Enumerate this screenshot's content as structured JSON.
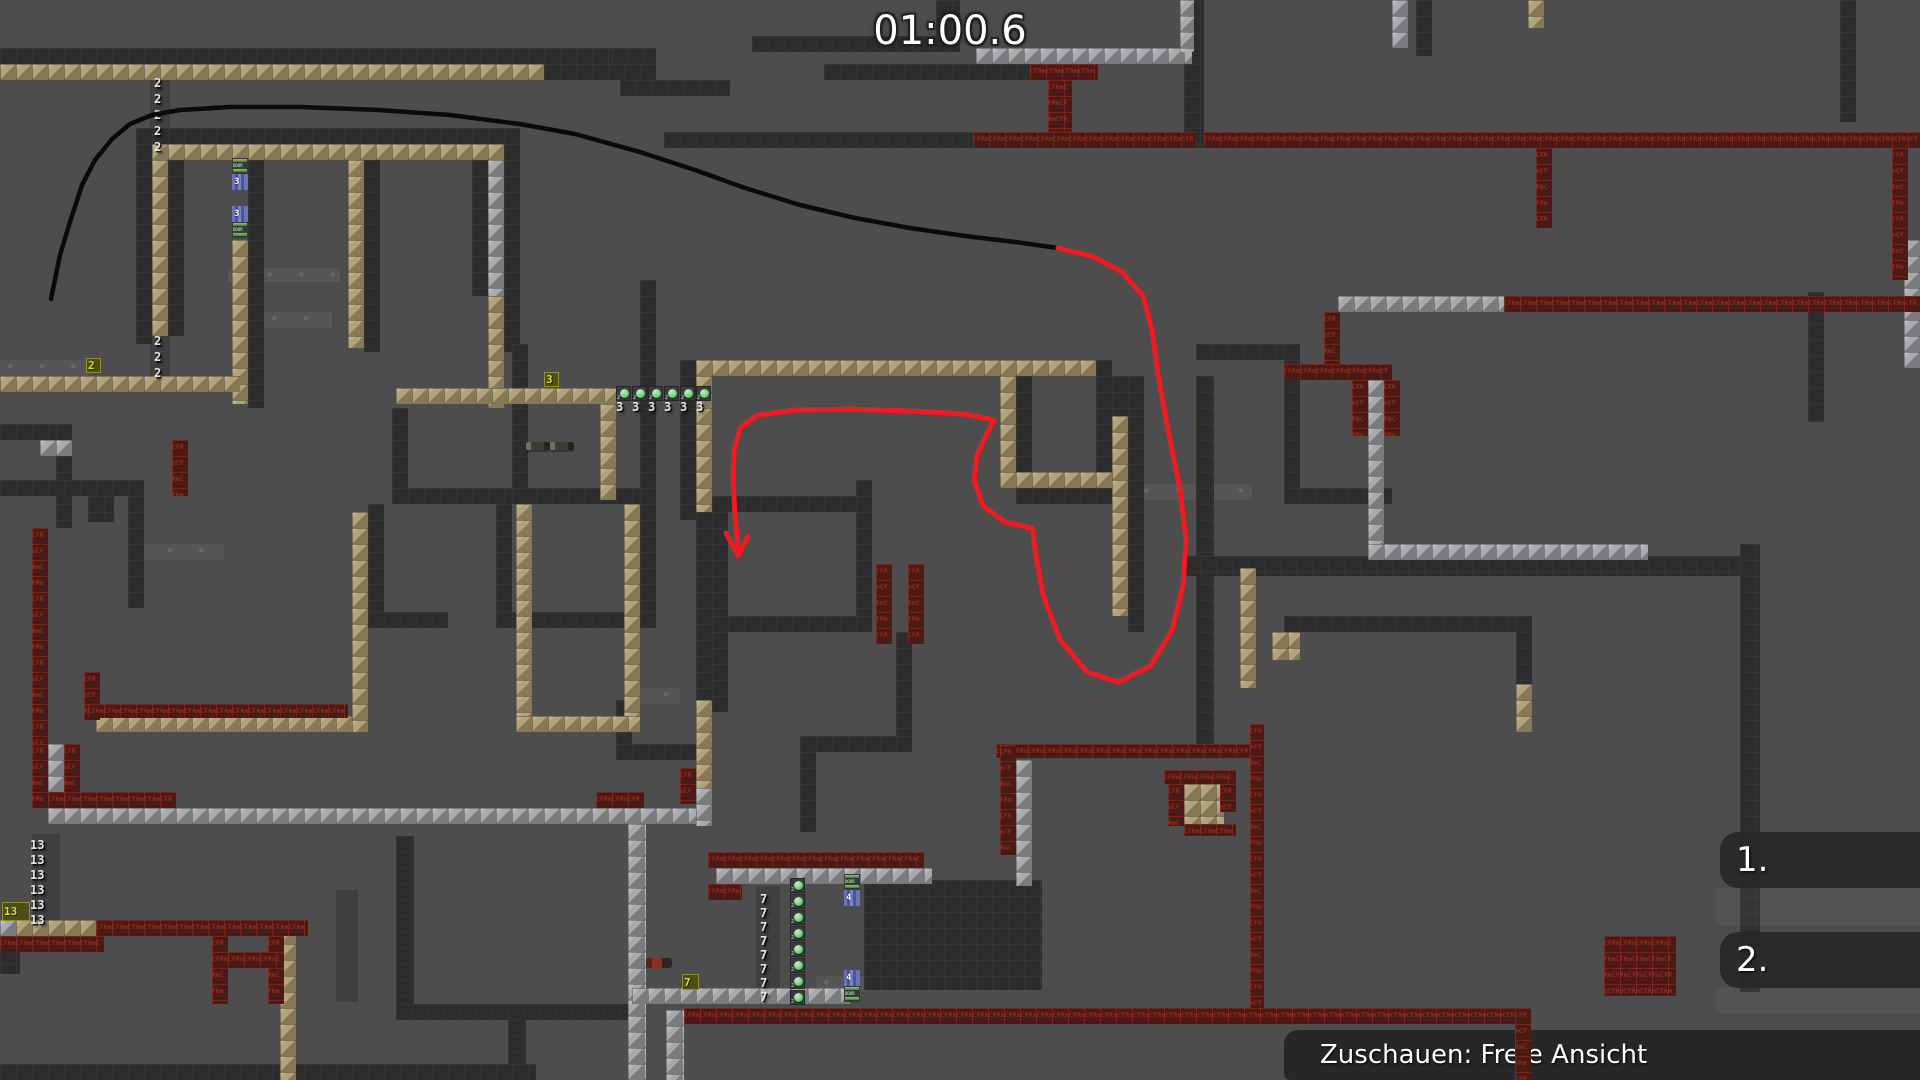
{
  "hud": {
    "timer": "01:00.6",
    "spectate_label": "Zuschauen: Freie Ansicht",
    "ranks": [
      "1.",
      "2."
    ]
  },
  "colors": {
    "background": "#4d4d4d",
    "wall": "#2d2d2d",
    "tan_tile": "#b3a277",
    "silver_tile": "#a8aaad",
    "red_tile": "#4a1a17",
    "red_tile_text_color": "#ad382a",
    "black_line": "#0a0a0a",
    "red_line": "#ee1b22",
    "hud_text": "#ffffff"
  },
  "map": {
    "red_tile_text": "CFRm",
    "star_char": "✶ ",
    "door_label": "DOOR",
    "button_small_label": "2",
    "walls": [
      [
        0,
        48,
        656,
        16
      ],
      [
        544,
        64,
        112,
        16
      ],
      [
        136,
        128,
        384,
        16
      ],
      [
        136,
        144,
        16,
        200
      ],
      [
        168,
        160,
        16,
        176
      ],
      [
        248,
        160,
        16,
        248
      ],
      [
        364,
        160,
        16,
        192
      ],
      [
        472,
        160,
        16,
        136
      ],
      [
        504,
        128,
        16,
        224
      ],
      [
        612,
        48,
        36,
        16
      ],
      [
        752,
        36,
        208,
        16
      ],
      [
        824,
        64,
        208,
        16
      ],
      [
        620,
        80,
        110,
        16
      ],
      [
        664,
        132,
        310,
        16
      ],
      [
        936,
        0,
        24,
        36
      ],
      [
        1184,
        0,
        20,
        148
      ],
      [
        1416,
        0,
        16,
        56
      ],
      [
        1840,
        0,
        16,
        122
      ],
      [
        0,
        424,
        56,
        16
      ],
      [
        56,
        424,
        16,
        104
      ],
      [
        0,
        480,
        144,
        16
      ],
      [
        128,
        496,
        16,
        112
      ],
      [
        88,
        496,
        26,
        26
      ],
      [
        392,
        408,
        16,
        96
      ],
      [
        392,
        488,
        248,
        16
      ],
      [
        640,
        280,
        16,
        340
      ],
      [
        368,
        504,
        16,
        112
      ],
      [
        496,
        504,
        16,
        112
      ],
      [
        512,
        344,
        16,
        160
      ],
      [
        368,
        612,
        80,
        16
      ],
      [
        496,
        612,
        160,
        16
      ],
      [
        680,
        360,
        16,
        160
      ],
      [
        696,
        512,
        16,
        188
      ],
      [
        616,
        700,
        16,
        48
      ],
      [
        616,
        744,
        96,
        16
      ],
      [
        1096,
        360,
        16,
        132
      ],
      [
        1016,
        376,
        16,
        96
      ],
      [
        1016,
        488,
        96,
        16
      ],
      [
        1112,
        376,
        32,
        40
      ],
      [
        1128,
        416,
        16,
        216
      ],
      [
        1196,
        376,
        18,
        368
      ],
      [
        712,
        496,
        160,
        16
      ],
      [
        712,
        496,
        16,
        136
      ],
      [
        856,
        480,
        16,
        152
      ],
      [
        712,
        616,
        160,
        16
      ],
      [
        712,
        632,
        16,
        80
      ],
      [
        896,
        632,
        16,
        120
      ],
      [
        800,
        736,
        112,
        16
      ],
      [
        800,
        752,
        16,
        80
      ],
      [
        1196,
        344,
        90,
        16
      ],
      [
        1284,
        344,
        16,
        156
      ],
      [
        1284,
        488,
        108,
        16
      ],
      [
        864,
        880,
        178,
        110
      ],
      [
        396,
        836,
        18,
        172
      ],
      [
        396,
        1004,
        244,
        16
      ],
      [
        508,
        1020,
        18,
        60
      ],
      [
        0,
        948,
        20,
        26
      ],
      [
        0,
        1064,
        536,
        16
      ],
      [
        1184,
        556,
        568,
        20
      ],
      [
        1740,
        544,
        20,
        448
      ],
      [
        1284,
        616,
        232,
        16
      ],
      [
        1516,
        616,
        16,
        76
      ],
      [
        1808,
        292,
        16,
        130
      ]
    ],
    "tan": [
      [
        0,
        64,
        544,
        16
      ],
      [
        152,
        144,
        352,
        16
      ],
      [
        152,
        160,
        16,
        176
      ],
      [
        232,
        240,
        16,
        164
      ],
      [
        348,
        160,
        16,
        188
      ],
      [
        488,
        296,
        16,
        112
      ],
      [
        0,
        376,
        240,
        16
      ],
      [
        396,
        388,
        220,
        16
      ],
      [
        600,
        404,
        16,
        96
      ],
      [
        696,
        360,
        400,
        16
      ],
      [
        696,
        376,
        16,
        136
      ],
      [
        1000,
        376,
        16,
        96
      ],
      [
        1000,
        472,
        112,
        16
      ],
      [
        1112,
        416,
        16,
        200
      ],
      [
        352,
        512,
        16,
        220
      ],
      [
        96,
        716,
        256,
        16
      ],
      [
        516,
        504,
        16,
        228
      ],
      [
        624,
        504,
        16,
        228
      ],
      [
        516,
        716,
        124,
        16
      ],
      [
        696,
        700,
        16,
        88
      ],
      [
        1240,
        568,
        16,
        120
      ],
      [
        1272,
        632,
        28,
        28
      ],
      [
        1516,
        684,
        16,
        48
      ],
      [
        1184,
        784,
        40,
        40
      ],
      [
        1620,
        948,
        48,
        44
      ],
      [
        280,
        928,
        16,
        152
      ],
      [
        16,
        920,
        80,
        16
      ],
      [
        1528,
        0,
        16,
        28
      ]
    ],
    "silver": [
      [
        976,
        48,
        216,
        16
      ],
      [
        1392,
        0,
        16,
        48
      ],
      [
        1180,
        0,
        14,
        52
      ],
      [
        488,
        160,
        16,
        136
      ],
      [
        40,
        440,
        32,
        16
      ],
      [
        1338,
        296,
        166,
        16
      ],
      [
        1368,
        380,
        16,
        168
      ],
      [
        1368,
        544,
        280,
        16
      ],
      [
        48,
        744,
        16,
        64
      ],
      [
        48,
        808,
        664,
        16
      ],
      [
        628,
        824,
        18,
        256
      ],
      [
        666,
        1010,
        18,
        70
      ],
      [
        696,
        788,
        16,
        38
      ],
      [
        716,
        868,
        216,
        16
      ],
      [
        1016,
        760,
        16,
        126
      ],
      [
        632,
        988,
        218,
        16
      ],
      [
        0,
        920,
        16,
        16
      ],
      [
        1904,
        240,
        16,
        128
      ]
    ],
    "red": [
      [
        1030,
        64,
        68,
        16
      ],
      [
        1048,
        80,
        24,
        52
      ],
      [
        973,
        132,
        222,
        16
      ],
      [
        1204,
        132,
        716,
        16
      ],
      [
        1536,
        148,
        16,
        80
      ],
      [
        1892,
        148,
        16,
        132
      ],
      [
        1504,
        296,
        416,
        16
      ],
      [
        1324,
        312,
        16,
        56
      ],
      [
        1284,
        364,
        108,
        16
      ],
      [
        1352,
        380,
        16,
        56
      ],
      [
        1384,
        380,
        16,
        56
      ],
      [
        172,
        440,
        16,
        56
      ],
      [
        32,
        528,
        16,
        216
      ],
      [
        32,
        744,
        16,
        64
      ],
      [
        64,
        744,
        16,
        64
      ],
      [
        48,
        792,
        128,
        16
      ],
      [
        596,
        792,
        48,
        16
      ],
      [
        84,
        672,
        16,
        48
      ],
      [
        88,
        704,
        260,
        14
      ],
      [
        876,
        564,
        16,
        80
      ],
      [
        908,
        564,
        16,
        80
      ],
      [
        680,
        768,
        16,
        36
      ],
      [
        708,
        852,
        216,
        16
      ],
      [
        708,
        884,
        34,
        16
      ],
      [
        996,
        744,
        266,
        14
      ],
      [
        1250,
        724,
        14,
        300
      ],
      [
        1000,
        745,
        16,
        110
      ],
      [
        1164,
        770,
        72,
        14
      ],
      [
        1168,
        784,
        16,
        42
      ],
      [
        1220,
        784,
        16,
        28
      ],
      [
        1184,
        824,
        52,
        12
      ],
      [
        0,
        936,
        104,
        16
      ],
      [
        96,
        920,
        212,
        16
      ],
      [
        212,
        936,
        16,
        68
      ],
      [
        268,
        936,
        16,
        68
      ],
      [
        212,
        952,
        72,
        16
      ],
      [
        684,
        1008,
        846,
        16
      ],
      [
        1604,
        936,
        72,
        60
      ]
    ],
    "red_over": [
      [
        1515,
        1008,
        16,
        72
      ]
    ],
    "bands": [
      [
        0,
        360,
        88,
        16
      ],
      [
        128,
        544,
        96,
        16
      ],
      [
        264,
        312,
        68,
        16
      ],
      [
        1136,
        484,
        116,
        16
      ],
      [
        624,
        688,
        56,
        16
      ],
      [
        816,
        976,
        48,
        16
      ],
      [
        228,
        268,
        112,
        14
      ]
    ],
    "shades": [
      [
        150,
        74,
        20,
        84
      ],
      [
        150,
        330,
        20,
        52
      ],
      [
        32,
        834,
        28,
        98
      ],
      [
        756,
        886,
        24,
        112
      ],
      [
        336,
        890,
        22,
        112
      ]
    ],
    "numbers": [
      {
        "v": "2",
        "x": 154,
        "y": 76
      },
      {
        "v": "2",
        "x": 154,
        "y": 92
      },
      {
        "v": "2",
        "x": 154,
        "y": 108
      },
      {
        "v": "2",
        "x": 154,
        "y": 124
      },
      {
        "v": "2",
        "x": 154,
        "y": 140
      },
      {
        "v": "2",
        "x": 154,
        "y": 334
      },
      {
        "v": "2",
        "x": 154,
        "y": 350
      },
      {
        "v": "2",
        "x": 154,
        "y": 366
      },
      {
        "v": "13",
        "x": 30,
        "y": 838
      },
      {
        "v": "13",
        "x": 30,
        "y": 853
      },
      {
        "v": "13",
        "x": 30,
        "y": 868
      },
      {
        "v": "13",
        "x": 30,
        "y": 883
      },
      {
        "v": "13",
        "x": 30,
        "y": 898
      },
      {
        "v": "13",
        "x": 30,
        "y": 913
      },
      {
        "v": "7",
        "x": 760,
        "y": 892
      },
      {
        "v": "7",
        "x": 760,
        "y": 906
      },
      {
        "v": "7",
        "x": 760,
        "y": 920
      },
      {
        "v": "7",
        "x": 760,
        "y": 934
      },
      {
        "v": "7",
        "x": 760,
        "y": 948
      },
      {
        "v": "7",
        "x": 760,
        "y": 962
      },
      {
        "v": "7",
        "x": 760,
        "y": 976
      },
      {
        "v": "7",
        "x": 760,
        "y": 990
      },
      {
        "v": "3",
        "x": 616,
        "y": 400
      },
      {
        "v": "3",
        "x": 632,
        "y": 400
      },
      {
        "v": "3",
        "x": 648,
        "y": 400
      },
      {
        "v": "3",
        "x": 664,
        "y": 400
      },
      {
        "v": "3",
        "x": 680,
        "y": 400
      },
      {
        "v": "3",
        "x": 696,
        "y": 400
      }
    ],
    "switches": [
      {
        "label": "2",
        "x": 86,
        "y": 358,
        "w": 15,
        "h": 15
      },
      {
        "label": "3",
        "x": 544,
        "y": 372,
        "w": 15,
        "h": 15
      },
      {
        "label": "7",
        "x": 682,
        "y": 974,
        "w": 17,
        "h": 16
      },
      {
        "label": "13",
        "x": 2,
        "y": 902,
        "w": 28,
        "h": 19
      }
    ],
    "button_rows": [
      {
        "x": 616,
        "y": 386,
        "count": 6,
        "dx": 16,
        "dy": 0
      },
      {
        "x": 790,
        "y": 878,
        "count": 8,
        "dx": 0,
        "dy": 16
      }
    ],
    "doors": [
      {
        "x": 232,
        "y": 158,
        "kind": "bars"
      },
      {
        "x": 232,
        "y": 174,
        "kind": "num",
        "n": "3"
      },
      {
        "x": 232,
        "y": 206,
        "kind": "num",
        "n": "3"
      },
      {
        "x": 232,
        "y": 222,
        "kind": "bars"
      },
      {
        "x": 844,
        "y": 874,
        "kind": "bars"
      },
      {
        "x": 844,
        "y": 890,
        "kind": "num",
        "n": "4"
      },
      {
        "x": 844,
        "y": 970,
        "kind": "num",
        "n": "4"
      },
      {
        "x": 844,
        "y": 986,
        "kind": "bars"
      }
    ],
    "pickups": [
      {
        "kind": "rifle",
        "x": 526,
        "y": 442
      },
      {
        "kind": "rifle",
        "x": 550,
        "y": 442
      },
      {
        "kind": "grenade",
        "x": 646,
        "y": 958
      }
    ]
  },
  "rank_panel": {
    "stripes": [
      [
        1716,
        888,
        204,
        38
      ],
      [
        1716,
        988,
        204,
        26
      ]
    ],
    "rows_y": [
      832,
      932
    ]
  },
  "lines": {
    "black": [
      [
        51,
        299
      ],
      [
        60,
        255
      ],
      [
        70,
        222
      ],
      [
        82,
        185
      ],
      [
        95,
        160
      ],
      [
        112,
        139
      ],
      [
        130,
        124
      ],
      [
        152,
        115
      ],
      [
        180,
        110
      ],
      [
        230,
        107
      ],
      [
        300,
        107
      ],
      [
        380,
        110
      ],
      [
        450,
        115
      ],
      [
        520,
        124
      ],
      [
        575,
        134
      ],
      [
        640,
        152
      ],
      [
        695,
        170
      ],
      [
        745,
        188
      ],
      [
        800,
        205
      ],
      [
        855,
        218
      ],
      [
        910,
        228
      ],
      [
        965,
        236
      ],
      [
        1015,
        242
      ],
      [
        1058,
        248
      ]
    ],
    "red": [
      [
        1058,
        248
      ],
      [
        1092,
        256
      ],
      [
        1122,
        272
      ],
      [
        1143,
        296
      ],
      [
        1152,
        330
      ],
      [
        1158,
        375
      ],
      [
        1168,
        430
      ],
      [
        1180,
        490
      ],
      [
        1186,
        540
      ],
      [
        1183,
        585
      ],
      [
        1172,
        630
      ],
      [
        1150,
        666
      ],
      [
        1118,
        682
      ],
      [
        1087,
        672
      ],
      [
        1060,
        640
      ],
      [
        1043,
        595
      ],
      [
        1035,
        550
      ],
      [
        1032,
        528
      ],
      [
        1005,
        522
      ],
      [
        983,
        506
      ],
      [
        974,
        480
      ],
      [
        977,
        455
      ],
      [
        987,
        433
      ],
      [
        994,
        420
      ],
      [
        965,
        414
      ],
      [
        910,
        411
      ],
      [
        850,
        409
      ],
      [
        795,
        410
      ],
      [
        757,
        415
      ],
      [
        740,
        428
      ],
      [
        734,
        450
      ],
      [
        733,
        480
      ],
      [
        735,
        515
      ],
      [
        738,
        548
      ]
    ],
    "arrow": [
      [
        726,
        533
      ],
      [
        738,
        556
      ],
      [
        748,
        536
      ]
    ]
  }
}
